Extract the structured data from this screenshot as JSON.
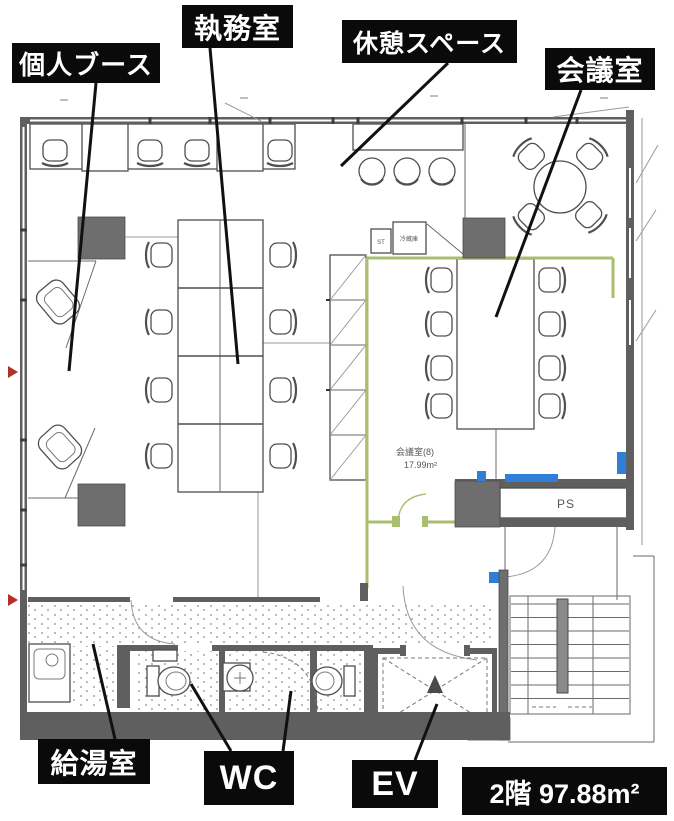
{
  "floorplan": {
    "labels": {
      "personal_booth": "個人ブース",
      "office": "執務室",
      "break_space": "休憩スペース",
      "meeting_room": "会議室",
      "kitchenette": "給湯室",
      "wc": "WC",
      "elevator": "EV",
      "floor_area": "2階 97.88m²"
    },
    "plan_texts": {
      "ps": "PS",
      "meeting_room_name": "会議室(8)",
      "meeting_room_area": "17.99m²",
      "st_unit": "ST",
      "refrigerator": "冷蔵庫"
    },
    "colors": {
      "label_background": "#0a0a0a",
      "label_text": "#ffffff",
      "structural_wall": "#5f5f5f",
      "pillar": "#6e6e6e",
      "new_partition_green": "#a9bf6e",
      "fixture_blue": "#2f7fd6",
      "entry_marker_red": "#b33028",
      "drawing_line": "#555555"
    }
  }
}
